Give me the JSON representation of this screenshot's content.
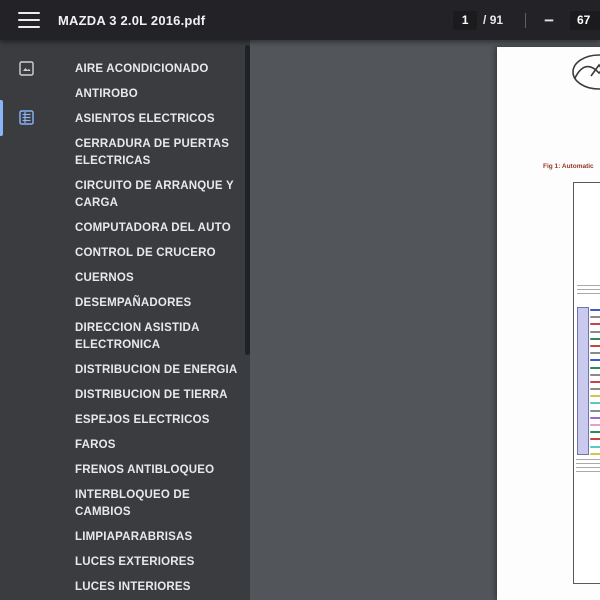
{
  "toolbar": {
    "title": "MAZDA 3 2.0L 2016.pdf",
    "page_current": "1",
    "page_total_label": "/ 91",
    "zoom_out_glyph": "−",
    "zoom_value": "67"
  },
  "sidebar": {
    "items": [
      "AIRE ACONDICIONADO",
      "ANTIROBO",
      "ASIENTOS ELECTRICOS",
      "CERRADURA DE PUERTAS ELECTRICAS",
      "CIRCUITO DE ARRANQUE Y CARGA",
      "COMPUTADORA DEL AUTO",
      "CONTROL DE CRUCERO",
      "CUERNOS",
      "DESEMPAÑADORES",
      "DIRECCION ASISTIDA ELECTRONICA",
      "DISTRIBUCION DE ENERGIA",
      "DISTRIBUCION DE TIERRA",
      "ESPEJOS ELECTRICOS",
      "FAROS",
      "FRENOS ANTIBLOQUEO",
      "INTERBLOQUEO DE CAMBIOS",
      "LIMPIAPARABRISAS",
      "LUCES EXTERIORES",
      "LUCES INTERIORES",
      "MALETERO, PUERTA"
    ]
  },
  "content": {
    "fig_caption": "Fig 1: Automatic",
    "wire_mark_colors": [
      "#3a5bc8",
      "#8a8a8a",
      "#c84444",
      "#8a8a8a",
      "#2e8b57",
      "#c84444",
      "#8a8a8a",
      "#3a5bc8",
      "#2e8b57",
      "#8a8a8a",
      "#c84444",
      "#8a8a8a",
      "#d4c84a",
      "#5bc8c8",
      "#8a8a8a",
      "#9a6ac8",
      "#e8a0c8",
      "#2e8b57",
      "#c84444",
      "#5bc8c8",
      "#d4c84a"
    ]
  },
  "colors": {
    "toolbar_bg": "#232327",
    "sidebar_bg": "#3a3c40",
    "viewer_bg": "#52565a",
    "accent_blue": "#8ab4f8",
    "connector_fill": "#c9caee",
    "caption_red": "#993322"
  }
}
